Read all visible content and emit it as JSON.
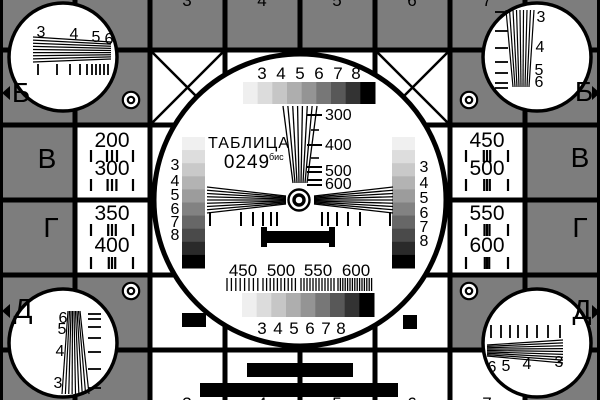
{
  "colors": {
    "bg": "#7d7d7d",
    "ink": "#000000",
    "paper": "#ffffff"
  },
  "title": {
    "line1": "ТАБЛИЦА",
    "number": "0249",
    "sup": "бис"
  },
  "cells": {
    "white": [
      [
        150,
        50,
        300,
        300
      ],
      [
        75,
        125,
        75,
        150
      ],
      [
        450,
        125,
        75,
        150
      ],
      [
        150,
        350,
        375,
        50
      ]
    ]
  },
  "grid": {
    "vx": [
      75,
      150,
      225,
      300,
      375,
      450,
      525
    ],
    "hy": [
      50,
      125,
      200,
      275,
      350
    ],
    "lw": 5,
    "edges": [
      [
        0,
        0,
        3,
        400
      ],
      [
        597,
        0,
        3,
        400
      ]
    ]
  },
  "circles": {
    "main": {
      "cx": 300,
      "cy": 200,
      "r": 146,
      "sw": 5
    },
    "corner": {
      "r": 54,
      "sw": 3.5,
      "centers": [
        [
          63,
          57
        ],
        [
          537,
          57
        ],
        [
          63,
          343
        ],
        [
          537,
          343
        ]
      ]
    }
  },
  "diagonals": {
    "sw": 2.5,
    "lines": [
      [
        150,
        50,
        225,
        125
      ],
      [
        225,
        50,
        150,
        125
      ],
      [
        375,
        50,
        450,
        125
      ],
      [
        450,
        50,
        375,
        125
      ]
    ]
  },
  "targets": {
    "outer_r": 8.2,
    "inner_r": 3.2,
    "sw": 2.2,
    "centers": [
      [
        131,
        100
      ],
      [
        469,
        100
      ],
      [
        131,
        291
      ],
      [
        469,
        291
      ]
    ]
  },
  "bullseye": {
    "cx": 299,
    "cy": 200,
    "outer_r": 10.5,
    "outer_sw": 2.4,
    "inner_r": 5,
    "inner_sw": 3.4
  },
  "staircases": [
    {
      "id": "grayscale-strip-top",
      "x": 243,
      "y": 82,
      "w": 132,
      "h": 22,
      "dir": "h",
      "colors": [
        "#efefef",
        "#dcdcdc",
        "#c6c6c6",
        "#aeaeae",
        "#949494",
        "#777777",
        "#585858",
        "#333333",
        "#000000"
      ]
    },
    {
      "id": "grayscale-strip-bottom",
      "x": 242,
      "y": 293,
      "w": 132,
      "h": 24,
      "dir": "h",
      "colors": [
        "#efefef",
        "#dcdcdc",
        "#c6c6c6",
        "#aeaeae",
        "#949494",
        "#777777",
        "#585858",
        "#333333",
        "#000000"
      ]
    },
    {
      "id": "grayscale-bar-left",
      "x": 182,
      "y": 137,
      "w": 23,
      "h": 131,
      "dir": "v",
      "colors": [
        "#f0f0f0",
        "#dddddd",
        "#c9c9c9",
        "#b3b3b3",
        "#9c9c9c",
        "#828282",
        "#676767",
        "#4a4a4a",
        "#2a2a2a",
        "#000000"
      ]
    },
    {
      "id": "grayscale-bar-right",
      "x": 392,
      "y": 137,
      "w": 23,
      "h": 131,
      "dir": "v",
      "colors": [
        "#f0f0f0",
        "#dddddd",
        "#c9c9c9",
        "#b3b3b3",
        "#9c9c9c",
        "#828282",
        "#676767",
        "#4a4a4a",
        "#2a2a2a",
        "#000000"
      ]
    }
  ],
  "wedges": [
    {
      "id": "wedge-center-vertical",
      "n": 8,
      "sw": 1.3,
      "dir": "v",
      "from": {
        "c": 106,
        "a": [
          283,
          317
        ]
      },
      "to": {
        "c": 183,
        "a": [
          293,
          307
        ]
      }
    },
    {
      "id": "wedge-center-left",
      "n": 9,
      "sw": 1.3,
      "dir": "h",
      "from": {
        "c": 207,
        "a": [
          187,
          213
        ]
      },
      "to": {
        "c": 286,
        "a": [
          196,
          204
        ]
      }
    },
    {
      "id": "wedge-center-right",
      "n": 9,
      "sw": 1.3,
      "dir": "h",
      "from": {
        "c": 314,
        "a": [
          196,
          204
        ]
      },
      "to": {
        "c": 393,
        "a": [
          187,
          213
        ]
      }
    },
    {
      "id": "wedge-top-left",
      "n": 9,
      "sw": 1.2,
      "dir": "h",
      "from": {
        "c": 33,
        "a": [
          37,
          62
        ]
      },
      "to": {
        "c": 111,
        "a": [
          42,
          59
        ]
      }
    },
    {
      "id": "wedge-top-right",
      "n": 9,
      "sw": 1.2,
      "dir": "v",
      "from": {
        "c": 10,
        "a": [
          506,
          534
        ]
      },
      "to": {
        "c": 87,
        "a": [
          513,
          529
        ]
      }
    },
    {
      "id": "wedge-bottom-left",
      "n": 9,
      "sw": 1.2,
      "dir": "v",
      "from": {
        "c": 311,
        "a": [
          68,
          80
        ]
      },
      "to": {
        "c": 394,
        "a": [
          62,
          89
        ]
      }
    },
    {
      "id": "wedge-bottom-right",
      "n": 9,
      "sw": 1.2,
      "dir": "h",
      "from": {
        "c": 487,
        "a": [
          345,
          356
        ]
      },
      "to": {
        "c": 563,
        "a": [
          340,
          363
        ]
      }
    }
  ],
  "tick_rows": [
    {
      "id": "ticks-top-left-circle",
      "dir": "v",
      "base": 64,
      "len": 11,
      "w": 1.8,
      "pos": [
        38,
        57,
        70,
        80,
        87,
        92,
        96,
        100,
        104,
        108
      ]
    },
    {
      "id": "ticks-top-right-circle",
      "dir": "h",
      "base": 495,
      "len": 13,
      "w": 1.8,
      "pos": [
        12,
        31,
        48,
        62,
        73,
        83,
        88
      ]
    },
    {
      "id": "ticks-bottom-left-circle",
      "dir": "h",
      "base": 88,
      "len": 13,
      "w": 1.8,
      "pos": [
        314,
        319,
        327,
        338,
        352,
        369,
        388
      ]
    },
    {
      "id": "ticks-bottom-right-circle",
      "dir": "v",
      "base": 325,
      "len": 13,
      "w": 1.8,
      "pos": [
        491,
        501,
        510,
        518,
        527,
        537,
        548,
        560
      ]
    },
    {
      "id": "ticks-center-left",
      "dir": "v",
      "base": 212,
      "len": 14,
      "w": 2,
      "pos": [
        210,
        241,
        253,
        263,
        271,
        277
      ]
    },
    {
      "id": "ticks-center-right",
      "dir": "v",
      "base": 212,
      "len": 14,
      "w": 2,
      "pos": [
        322,
        328,
        337,
        348,
        360,
        390
      ]
    },
    {
      "id": "wedge-scale-dashes",
      "dir": "h",
      "base": 307,
      "len": 15,
      "w": 2,
      "pos": [
        115,
        145,
        167,
        172,
        180,
        185
      ]
    },
    {
      "id": "wedge-scale-dashes-small",
      "dir": "h",
      "base": 311,
      "len": 8,
      "w": 1.6,
      "pos": [
        130,
        158
      ]
    }
  ],
  "freq_groups": [
    {
      "id": "freq-ticks-200",
      "cx": 112,
      "y": 150,
      "h": 12,
      "outer": 21,
      "sp": 5
    },
    {
      "id": "freq-ticks-300",
      "cx": 112,
      "y": 179,
      "h": 12,
      "outer": 21,
      "sp": 4.4
    },
    {
      "id": "freq-ticks-350",
      "cx": 112,
      "y": 224,
      "h": 12,
      "outer": 21,
      "sp": 3.8
    },
    {
      "id": "freq-ticks-400",
      "cx": 112,
      "y": 257,
      "h": 12,
      "outer": 21,
      "sp": 3.2
    },
    {
      "id": "freq-ticks-450",
      "cx": 487,
      "y": 150,
      "h": 12,
      "outer": 21,
      "sp": 3.2
    },
    {
      "id": "freq-ticks-500",
      "cx": 487,
      "y": 179,
      "h": 12,
      "outer": 21,
      "sp": 2.8
    },
    {
      "id": "freq-ticks-550",
      "cx": 487,
      "y": 224,
      "h": 12,
      "outer": 21,
      "sp": 2.5
    },
    {
      "id": "freq-ticks-600",
      "cx": 487,
      "y": 257,
      "h": 12,
      "outer": 21,
      "sp": 2.2
    }
  ],
  "bursts": {
    "y": 278,
    "h": 13,
    "lw": 1.3,
    "segs": [
      {
        "x": 227,
        "w": 34,
        "p": 4.4
      },
      {
        "x": 263,
        "w": 36,
        "p": 3.6
      },
      {
        "x": 301,
        "w": 35,
        "p": 3.0
      },
      {
        "x": 338,
        "w": 34,
        "p": 2.4
      }
    ]
  },
  "black_rects": [
    {
      "id": "center-black-bar",
      "x": 263,
      "y": 231,
      "w": 70,
      "h": 12
    },
    {
      "id": "center-bar-cap-left",
      "x": 261,
      "y": 227,
      "w": 6,
      "h": 20
    },
    {
      "id": "center-bar-cap-right",
      "x": 329,
      "y": 227,
      "w": 6,
      "h": 20
    },
    {
      "id": "bottom-bar-short",
      "x": 247,
      "y": 363,
      "w": 106,
      "h": 14
    },
    {
      "id": "bottom-bar-long",
      "x": 200,
      "y": 383,
      "w": 198,
      "h": 14
    },
    {
      "id": "black-rect-row-d-left",
      "x": 182,
      "y": 313,
      "w": 24,
      "h": 14
    },
    {
      "id": "black-square-row-d-right",
      "x": 403,
      "y": 315,
      "w": 14,
      "h": 14
    }
  ],
  "arrows": [
    {
      "id": "arrow-left-b",
      "points": "10,86 10,100 2,93"
    },
    {
      "id": "arrow-right-b",
      "points": "592,86 592,100 600,93"
    },
    {
      "id": "arrow-left-d",
      "points": "10,304 10,318 2,311"
    },
    {
      "id": "arrow-right-d",
      "points": "592,305 592,319 600,312"
    }
  ],
  "labels": [
    {
      "id": "row-label-b-left",
      "t": "Б",
      "x": 21,
      "y": 102,
      "fs": 28
    },
    {
      "id": "row-label-b-right",
      "t": "Б",
      "x": 584,
      "y": 101,
      "fs": 28
    },
    {
      "id": "row-label-v-left",
      "t": "В",
      "x": 47,
      "y": 168,
      "fs": 28
    },
    {
      "id": "row-label-v-right",
      "t": "В",
      "x": 580,
      "y": 167,
      "fs": 28
    },
    {
      "id": "row-label-g-left",
      "t": "Г",
      "x": 51,
      "y": 237,
      "fs": 28
    },
    {
      "id": "row-label-g-right",
      "t": "Г",
      "x": 580,
      "y": 237,
      "fs": 28
    },
    {
      "id": "row-label-d-left",
      "t": "Д",
      "x": 23,
      "y": 318,
      "fs": 28
    },
    {
      "id": "row-label-d-right",
      "t": "Д",
      "x": 582,
      "y": 319,
      "fs": 28
    },
    {
      "id": "freq-200",
      "t": "200",
      "x": 112,
      "y": 147,
      "fs": 21
    },
    {
      "id": "freq-300",
      "t": "300",
      "x": 112,
      "y": 175,
      "fs": 21
    },
    {
      "id": "freq-350",
      "t": "350",
      "x": 112,
      "y": 220,
      "fs": 21
    },
    {
      "id": "freq-400",
      "t": "400",
      "x": 112,
      "y": 252,
      "fs": 21
    },
    {
      "id": "freq-450",
      "t": "450",
      "x": 487,
      "y": 147,
      "fs": 21
    },
    {
      "id": "freq-500",
      "t": "500",
      "x": 487,
      "y": 175,
      "fs": 21
    },
    {
      "id": "freq-550",
      "t": "550",
      "x": 487,
      "y": 220,
      "fs": 21
    },
    {
      "id": "freq-600",
      "t": "600",
      "x": 487,
      "y": 252,
      "fs": 21
    },
    {
      "id": "strip-top-3",
      "t": "3",
      "x": 262,
      "y": 79,
      "fs": 17
    },
    {
      "id": "strip-top-4",
      "t": "4",
      "x": 281,
      "y": 79,
      "fs": 17
    },
    {
      "id": "strip-top-5",
      "t": "5",
      "x": 300,
      "y": 79,
      "fs": 17
    },
    {
      "id": "strip-top-6",
      "t": "6",
      "x": 319,
      "y": 79,
      "fs": 17
    },
    {
      "id": "strip-top-7",
      "t": "7",
      "x": 338,
      "y": 79,
      "fs": 17
    },
    {
      "id": "strip-top-8",
      "t": "8",
      "x": 356,
      "y": 79,
      "fs": 17
    },
    {
      "id": "strip-bottom-3",
      "t": "3",
      "x": 262,
      "y": 334,
      "fs": 17
    },
    {
      "id": "strip-bottom-4",
      "t": "4",
      "x": 278,
      "y": 334,
      "fs": 17
    },
    {
      "id": "strip-bottom-5",
      "t": "5",
      "x": 294,
      "y": 334,
      "fs": 17
    },
    {
      "id": "strip-bottom-6",
      "t": "6",
      "x": 310,
      "y": 334,
      "fs": 17
    },
    {
      "id": "strip-bottom-7",
      "t": "7",
      "x": 326,
      "y": 334,
      "fs": 17
    },
    {
      "id": "strip-bottom-8",
      "t": "8",
      "x": 341,
      "y": 334,
      "fs": 17
    },
    {
      "id": "stair-left-3",
      "t": "3",
      "x": 175,
      "y": 170,
      "fs": 16
    },
    {
      "id": "stair-left-4",
      "t": "4",
      "x": 175,
      "y": 186,
      "fs": 16
    },
    {
      "id": "stair-left-5",
      "t": "5",
      "x": 175,
      "y": 200,
      "fs": 16
    },
    {
      "id": "stair-left-6",
      "t": "6",
      "x": 175,
      "y": 214,
      "fs": 16
    },
    {
      "id": "stair-left-7",
      "t": "7",
      "x": 175,
      "y": 227,
      "fs": 16
    },
    {
      "id": "stair-left-8",
      "t": "8",
      "x": 175,
      "y": 240,
      "fs": 16
    },
    {
      "id": "stair-right-3",
      "t": "3",
      "x": 424,
      "y": 172,
      "fs": 16
    },
    {
      "id": "stair-right-4",
      "t": "4",
      "x": 424,
      "y": 188,
      "fs": 16
    },
    {
      "id": "stair-right-5",
      "t": "5",
      "x": 424,
      "y": 203,
      "fs": 16
    },
    {
      "id": "stair-right-6",
      "t": "6",
      "x": 424,
      "y": 218,
      "fs": 16
    },
    {
      "id": "stair-right-7",
      "t": "7",
      "x": 424,
      "y": 232,
      "fs": 16
    },
    {
      "id": "stair-right-8",
      "t": "8",
      "x": 424,
      "y": 246,
      "fs": 16
    },
    {
      "id": "burst-label-450",
      "t": "450",
      "x": 243,
      "y": 276,
      "fs": 17
    },
    {
      "id": "burst-label-500",
      "t": "500",
      "x": 281,
      "y": 276,
      "fs": 17
    },
    {
      "id": "burst-label-550",
      "t": "550",
      "x": 318,
      "y": 276,
      "fs": 17
    },
    {
      "id": "burst-label-600",
      "t": "600",
      "x": 356,
      "y": 276,
      "fs": 17
    },
    {
      "id": "wedge-scale-300",
      "t": "300",
      "x": 325,
      "y": 120,
      "fs": 16,
      "anchor": "start"
    },
    {
      "id": "wedge-scale-400",
      "t": "400",
      "x": 325,
      "y": 150,
      "fs": 16,
      "anchor": "start"
    },
    {
      "id": "wedge-scale-500",
      "t": "500",
      "x": 325,
      "y": 176,
      "fs": 16,
      "anchor": "start"
    },
    {
      "id": "wedge-scale-600",
      "t": "600",
      "x": 325,
      "y": 189,
      "fs": 16,
      "anchor": "start"
    },
    {
      "id": "wedge-tl-3",
      "t": "3",
      "x": 41,
      "y": 37,
      "fs": 16
    },
    {
      "id": "wedge-tl-4",
      "t": "4",
      "x": 74,
      "y": 39,
      "fs": 16
    },
    {
      "id": "wedge-tl-5",
      "t": "5",
      "x": 96,
      "y": 42,
      "fs": 16
    },
    {
      "id": "wedge-tl-6",
      "t": "6",
      "x": 109,
      "y": 44,
      "fs": 16
    },
    {
      "id": "wedge-tr-3",
      "t": "3",
      "x": 541,
      "y": 22,
      "fs": 16
    },
    {
      "id": "wedge-tr-4",
      "t": "4",
      "x": 540,
      "y": 52,
      "fs": 16
    },
    {
      "id": "wedge-tr-5",
      "t": "5",
      "x": 539,
      "y": 75,
      "fs": 16
    },
    {
      "id": "wedge-tr-6",
      "t": "6",
      "x": 539,
      "y": 87,
      "fs": 16
    },
    {
      "id": "wedge-bl-6",
      "t": "6",
      "x": 63,
      "y": 323,
      "fs": 16
    },
    {
      "id": "wedge-bl-5",
      "t": "5",
      "x": 62,
      "y": 334,
      "fs": 16
    },
    {
      "id": "wedge-bl-4",
      "t": "4",
      "x": 60,
      "y": 356,
      "fs": 16
    },
    {
      "id": "wedge-bl-3",
      "t": "3",
      "x": 58,
      "y": 388,
      "fs": 16
    },
    {
      "id": "wedge-br-6",
      "t": "6",
      "x": 492,
      "y": 372,
      "fs": 16
    },
    {
      "id": "wedge-br-5",
      "t": "5",
      "x": 506,
      "y": 371,
      "fs": 16
    },
    {
      "id": "wedge-br-4",
      "t": "4",
      "x": 527,
      "y": 369,
      "fs": 16
    },
    {
      "id": "wedge-br-3",
      "t": "3",
      "x": 559,
      "y": 367,
      "fs": 16
    },
    {
      "id": "edge-top-3",
      "t": "3",
      "x": 187,
      "y": 6,
      "fs": 17
    },
    {
      "id": "edge-top-4",
      "t": "4",
      "x": 262,
      "y": 6,
      "fs": 17
    },
    {
      "id": "edge-top-5",
      "t": "5",
      "x": 337,
      "y": 6,
      "fs": 17
    },
    {
      "id": "edge-top-6",
      "t": "6",
      "x": 412,
      "y": 6,
      "fs": 17
    },
    {
      "id": "edge-top-7",
      "t": "7",
      "x": 487,
      "y": 6,
      "fs": 17
    },
    {
      "id": "edge-bottom-3",
      "t": "3",
      "x": 187,
      "y": 409,
      "fs": 17
    },
    {
      "id": "edge-bottom-4",
      "t": "4",
      "x": 262,
      "y": 409,
      "fs": 17
    },
    {
      "id": "edge-bottom-5",
      "t": "5",
      "x": 337,
      "y": 409,
      "fs": 17
    },
    {
      "id": "edge-bottom-6",
      "t": "6",
      "x": 412,
      "y": 409,
      "fs": 17
    },
    {
      "id": "edge-bottom-7",
      "t": "7",
      "x": 487,
      "y": 409,
      "fs": 17
    }
  ]
}
